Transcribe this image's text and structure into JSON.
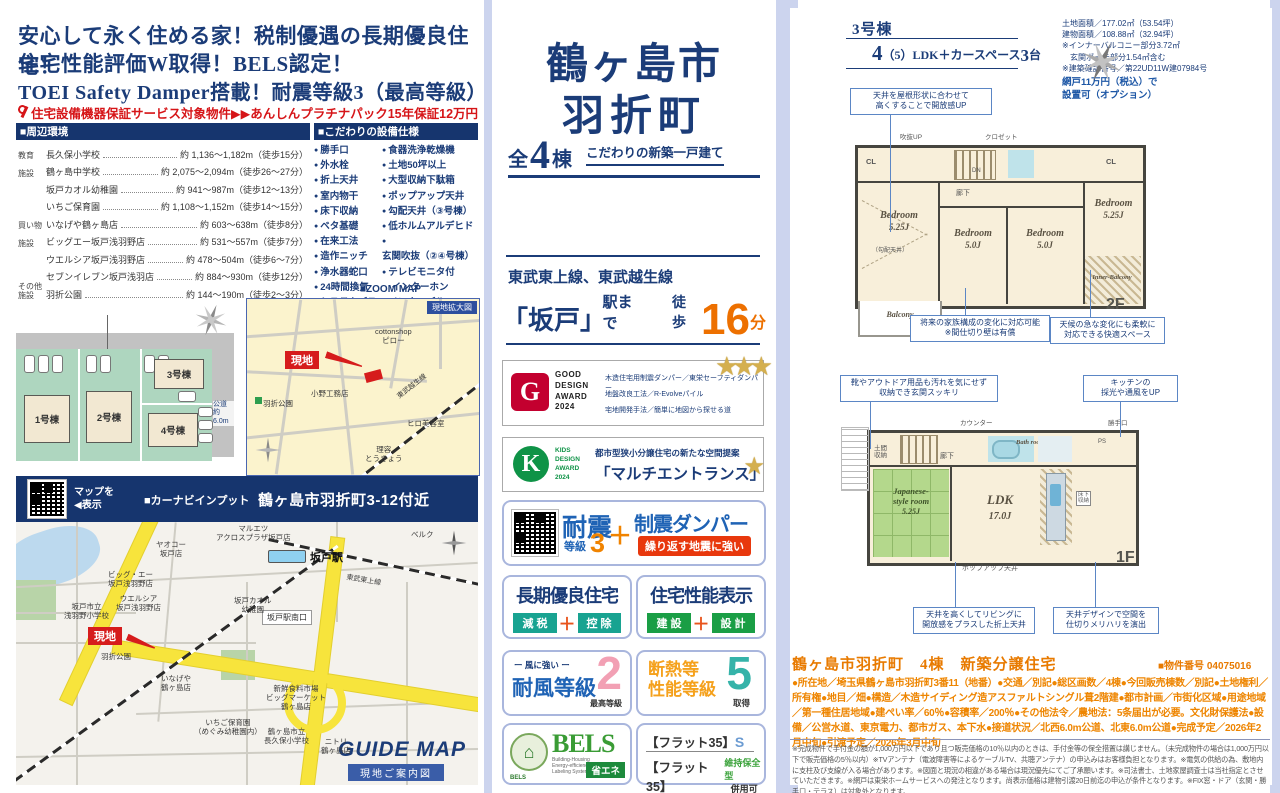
{
  "colors": {
    "navy": "#1b3c78",
    "red": "#d61518",
    "orange_walk": "#ed7000",
    "orange_detail": "#ee8500",
    "map_red": "#d61c1c"
  },
  "left": {
    "headline1": "安心して永く住める家！税制優遇の長期優良住宅！",
    "headline2": "住宅性能評価W取得！BELS認定！",
    "headline3": "TOEI Safety Damper搭載！耐震等級3（最高等級）",
    "warranty": "住宅設備機器保証サービス対象物件▶▶あんしんプラチナパック15年保証12万円（税込）",
    "env": {
      "title": "■周辺環境",
      "rows": [
        {
          "cat": "教育",
          "name": "長久保小学校",
          "val": "約 1,136～1,182m（徒歩15分）"
        },
        {
          "cat": "施設",
          "name": "鶴ヶ島中学校",
          "val": "約 2,075～2,094m（徒歩26～27分）"
        },
        {
          "cat": "",
          "name": "坂戸カオル幼稚園",
          "val": "約 941～987m（徒歩12～13分）"
        },
        {
          "cat": "",
          "name": "いちご保育園",
          "val": "約 1,108～1,152m（徒歩14～15分）"
        },
        {
          "cat": "買い物",
          "name": "いなげや鶴ヶ島店",
          "val": "約 603～638m（徒歩8分）"
        },
        {
          "cat": "施設",
          "name": "ビッグエー坂戸浅羽野店",
          "val": "約 531～557m（徒歩7分）"
        },
        {
          "cat": "",
          "name": "ウエルシア坂戸浅羽野店",
          "val": "約 478～504m（徒歩6～7分）"
        },
        {
          "cat": "",
          "name": "セブンイレブン坂戸浅羽店",
          "val": "約 884～930m（徒歩12分）"
        },
        {
          "cat": "その他\n施設",
          "name": "羽折公園",
          "val": "約 144～190m（徒歩2～3分）"
        }
      ]
    },
    "equip": {
      "title": "■こだわりの設備仕様",
      "col1": [
        "勝手口",
        "外水栓",
        "折上天井",
        "室内物干",
        "床下収納",
        "ベタ基礎",
        "在来工法",
        "造作ニッチ",
        "浄水器蛇口",
        "24時間換気",
        "システムバス",
        "手すり付階段",
        "制震ダンパー",
        "対面式キッチン"
      ],
      "col2": [
        "食器洗浄乾燥機",
        "土地50坪以上",
        "大型収納下駄箱",
        "ポップアップ天井",
        "勾配天井（③号棟）",
        "低ホルムアルデヒド",
        "玄関吹抜（②④号棟）",
        "テレビモニタ付\n　インターホン",
        "インナーバルコニー\n　（③④号棟）",
        "ウォークインクロゼット\n　（④号棟）",
        "主寝室8帖以上（①③号棟）"
      ]
    },
    "siteplan": {
      "road_top": "公道\n約6.0m",
      "road_right": "公道\n約6.0m",
      "lot1": "1号棟",
      "lot2": "2号棟",
      "lot3": "3号棟",
      "lot4": "4号棟"
    },
    "zoommap": {
      "title": "■ZOOM MAP",
      "tag": "現地拡大図",
      "genchi": "現地",
      "cotton": "cottonshop\nピロー",
      "ono": "小野工務店",
      "park": "羽折公園",
      "salon": "ヒロ美容室",
      "barber": "理容\nとうきょう",
      "rail": "東武越生線"
    },
    "navibar": {
      "qr_hint": "マップを\n◀表示",
      "label": "■カーナビインプット",
      "address": "鶴ヶ島市羽折町3-12付近"
    },
    "guidemap": {
      "genchi": "現地",
      "station": "坂戸駅",
      "minami": "坂戸駅南口",
      "maruetsu": "マルエツ\nアクロスプラザ坂戸店",
      "belc": "ベルク",
      "yaoko": "ヤオコー\n坂戸店",
      "bigA": "ビッグ・エー\n坂戸浅羽野店",
      "welcia": "ウエルシア\n坂戸浅羽野店",
      "asabano": "坂戸市立\n浅羽野小学校",
      "kaoru": "坂戸カオル\n幼稚園",
      "park": "羽折公園",
      "inageya": "いなげや\n鶴ヶ島店",
      "market": "新鮮食料市場\nビッグマーケット\n鶴ヶ島店",
      "ichigo": "いちご保育園\n（めぐみ幼稚園内）",
      "nagakubo": "鶴ヶ島市立\n長久保小学校",
      "nitori": "ニトリ\n鶴ヶ島店",
      "tojo": "東武東上線",
      "guide": "GUIDE MAP",
      "guide_tag": "現地ご案内図"
    }
  },
  "center": {
    "city": "鶴ヶ島市",
    "town": "羽折町",
    "zen": "全",
    "num": "4",
    "tou": "棟",
    "tagline": "こだわりの新築一戸建て",
    "lines": "東武東上線、東武越生線",
    "station": "「坂戸」",
    "st_suffix": "駅まで",
    "walk": "徒歩",
    "min": "16",
    "min_unit": "分",
    "gd": {
      "g": "G",
      "logo_text": "GOOD\nDESIGN\nAWARD\n2024",
      "l1": "木造住宅用制震ダンパー／東栄セーフティダンパー",
      "l2": "地盤改良工法／R-Evolveパイル",
      "l3": "宅地開発手法／簡単に地図から探せる道",
      "stars": "★★★"
    },
    "kids": {
      "k": "K",
      "logo_text": "KIDS\nDESIGN\nAWARD\n2024",
      "l1": "都市型狭小分譲住宅の新たな空間提案",
      "l2": "「マルチエントランス」",
      "star": "★"
    },
    "taishin": {
      "t1": "耐震",
      "t2": "等級",
      "n": "3",
      "plus": "＋",
      "t3": "制震ダンパー",
      "badge": "繰り返す地震に強い"
    },
    "choki": {
      "title": "長期優良住宅",
      "a": "減 税",
      "plus": "＋",
      "b": "控 除"
    },
    "hyoji": {
      "title": "住宅性能表示",
      "a": "建 設",
      "plus": "＋",
      "b": "設 計"
    },
    "taifu": {
      "sub": "ー 風に強い ー",
      "title": "耐風等級",
      "n": "2",
      "note": "最高等級"
    },
    "dan": {
      "title": "断熱等\n性能等級",
      "n": "5",
      "note": "取得"
    },
    "bels": {
      "house": "⌂",
      "name": "BELS",
      "sub": "Building-Housing\nEnergy-efficiency\nLabeling System",
      "tag": "省エネ"
    },
    "flat": {
      "a": "【フラット35】",
      "as": "S",
      "b": "【フラット35】",
      "bs": "維持保全型",
      "bt": "併用可"
    }
  },
  "right": {
    "unit": "3号棟",
    "plan_n1": "4",
    "plan_mid": "（5）LDK＋カースペース",
    "plan_n2": "3",
    "plan_unit": "台",
    "land": "土地面積／177.02㎡（53.54坪）",
    "bldg": "建物面積／108.88㎡（32.94坪）",
    "note1": "※インナーバルコニー部分3.72㎡",
    "note2": "　玄関ポーチ部分1.54㎡含む",
    "note3": "※建築確認番号／第22UD11W建07984号",
    "amido": "網戸11万円（税込）で\n設置可（オプション）",
    "f2": {
      "callout_top": "天井を屋根形状に合わせて\n高くすることで開放感UP",
      "label": "2F",
      "bed1": "Bedroom",
      "bed1s": "5.25J",
      "koubai": "（勾配天井）",
      "bed2": "Bedroom",
      "bed2s": "5.0J",
      "bed3": "Bedroom",
      "bed3s": "5.0J",
      "bed4": "Bedroom",
      "bed4s": "5.25J",
      "cl1": "CL",
      "cl2": "CL",
      "hall": "廊下",
      "dn": "DN",
      "fukinuke": "吹抜UP",
      "closet": "クロゼット",
      "balcony": "Balcony",
      "inner": "Inner-Balcony",
      "callout1": "将来の家族構成の変化に対応可能\n※間仕切り壁は有償",
      "callout2": "天候の急な変化にも柔軟に\n対応できる快適スペース"
    },
    "f1": {
      "callout1": "靴やアウトドア用品も汚れを気にせず\n収納でき玄関スッキリ",
      "callout2": "キッチンの\n採光や通風をUP",
      "label": "1F",
      "jroom": "Japanese-\nstyle room",
      "jrooms": "5.25J",
      "ldk": "LDK",
      "ldks": "17.0J",
      "bath": "Bath\nroom",
      "doma": "土間\n収納",
      "hall": "廊下",
      "counter": "カウンター",
      "katte": "勝手口",
      "ps": "PS",
      "yukashita": "床下\n収納",
      "popup": "ポップアップ天井",
      "callout3": "天井を高くしてリビングに\n開放感をプラスした折上天井",
      "callout4": "天井デザインで空間を\n仕切りメリハリを演出"
    },
    "prop_title": "鶴ヶ島市羽折町　4棟　新築分譲住宅",
    "prop_no": "■物件番号 04075016",
    "details": "●所在地／埼玉県鶴ヶ島市羽折町3番11（地番）●交通／別記●総区画数／4棟●今回販売棟数／別記●土地権利／所有権●地目／畑●構造／木造サイディング造アスファルトシングル葺2階建●都市計画／市街化区域●用途地域／第一種住居地域●建ぺい率／60％●容積率／200％●その他法令／農地法：5条届出が必要。文化財保護法●設備／公営水道、東京電力、都市ガス、本下水●接道状況／北西6.0m公道、北東6.0m公道●完成予定／2026年2月中旬●引渡予定／2026年3月中旬",
    "fineprint": "※完成物件で手付金の額が1,000万円以下であり且つ販売価格の10％以内のときは、手付金等の保全措置は講じません。（未完成物件の場合は1,000万円以下で販売価格の5％以内）※TVアンテナ（電波障害等によるケーブルTV、共聴アンテナ）の申込みはお客様負担となります。※電気の供給の為、敷地内に支柱及び支線が入る場合があります。※図面と現況の相違がある場合は現況優先にてご了承願います。※司法書士、土地家屋調査士は当社指定とさせていただきます。※網戸は東栄ホームサービスへの発注となります。尚表示価格は建物引渡20日前迄の申込が条件となります。※FIX窓・ドア（玄関・勝手口・テラス）は対象外となります。"
  }
}
